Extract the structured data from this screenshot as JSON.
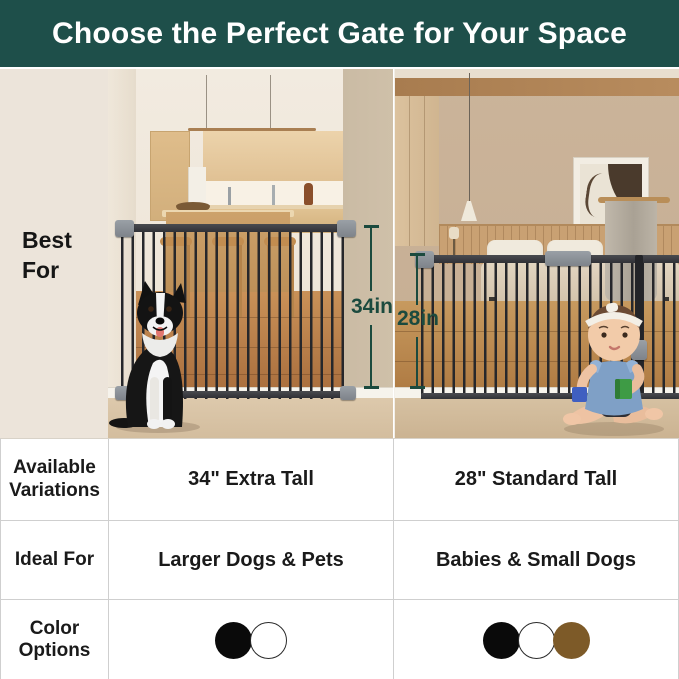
{
  "header": {
    "title": "Choose the Perfect Gate for Your Space",
    "bg_color": "#1e4f4a",
    "text_color": "#ffffff"
  },
  "sidebar": {
    "best_for_label": "Best For",
    "bg_color": "#ece4da"
  },
  "photos": {
    "left": {
      "scene": "kitchen with black-and-white dog sitting in front of extra tall black metal gate",
      "height_label": "34in"
    },
    "right": {
      "scene": "bedroom with baby sitting in front of standard tall black metal gate",
      "height_label": "28in"
    },
    "measure_line_color": "#1b4a3e"
  },
  "table": {
    "border_color": "#cfcfcf",
    "rows": [
      {
        "label": "Available Variations",
        "left_value": "34\" Extra Tall",
        "right_value": "28\" Standard Tall"
      },
      {
        "label": "Ideal For",
        "left_value": "Larger Dogs & Pets",
        "right_value": "Babies & Small Dogs"
      },
      {
        "label": "Color Options",
        "left_swatches": [
          "#0a0a0a",
          "#ffffff"
        ],
        "right_swatches": [
          "#0a0a0a",
          "#ffffff",
          "#7d5a28"
        ]
      }
    ]
  }
}
